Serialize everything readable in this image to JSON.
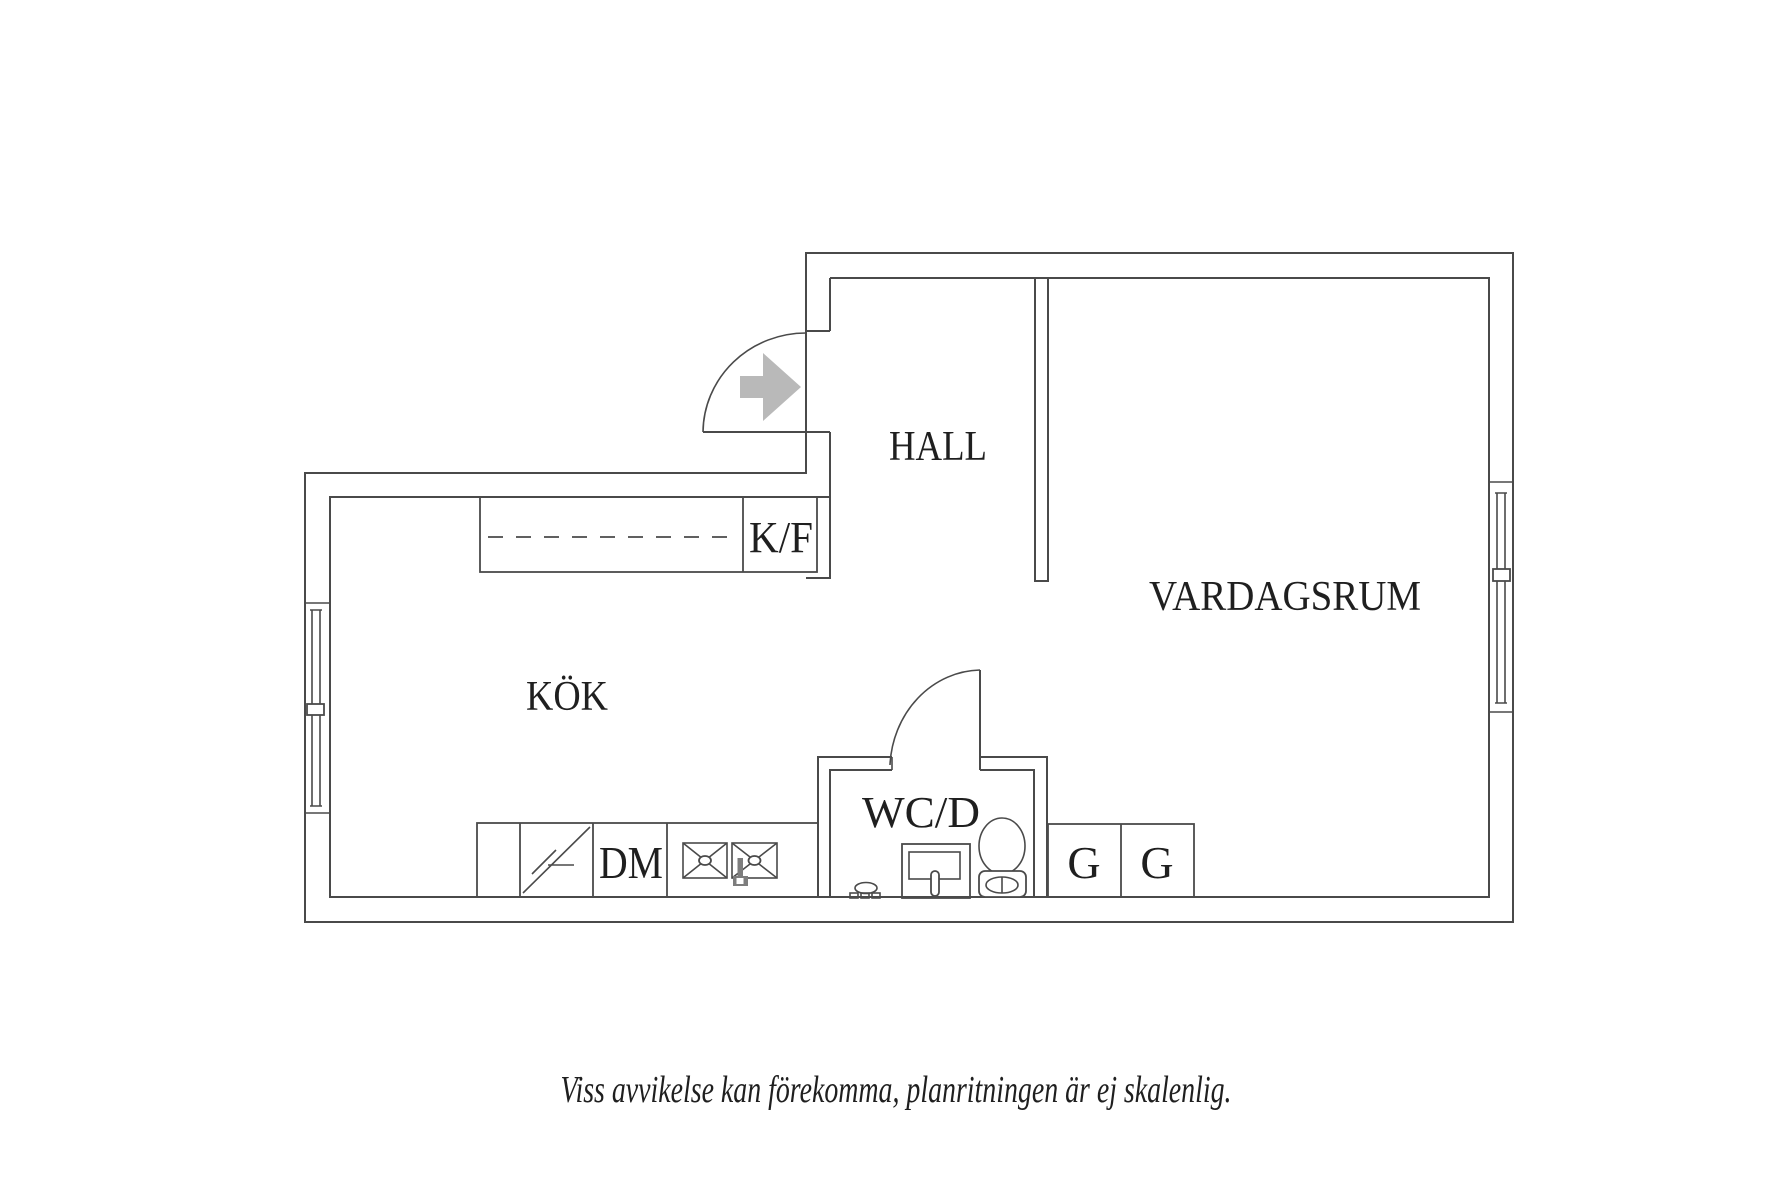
{
  "caption": "Viss avvikelse kan förekomma, planritningen är ej skalenlig.",
  "rooms": {
    "hall": "HALL",
    "vardagsrum": "VARDAGSRUM",
    "kok": "KÖK",
    "wcd": "WC/D"
  },
  "fixtures": {
    "fridge_freezer": "K/F",
    "dishwasher": "DM",
    "wardrobe_1": "G",
    "wardrobe_2": "G"
  },
  "icons": {
    "entry_direction": "right-arrow"
  },
  "colors": {
    "line": "#4a4a4a",
    "text": "#1f1f1f",
    "arrow": "#b9b9b9",
    "fixture": "#7d7d7d",
    "background": "#ffffff"
  }
}
